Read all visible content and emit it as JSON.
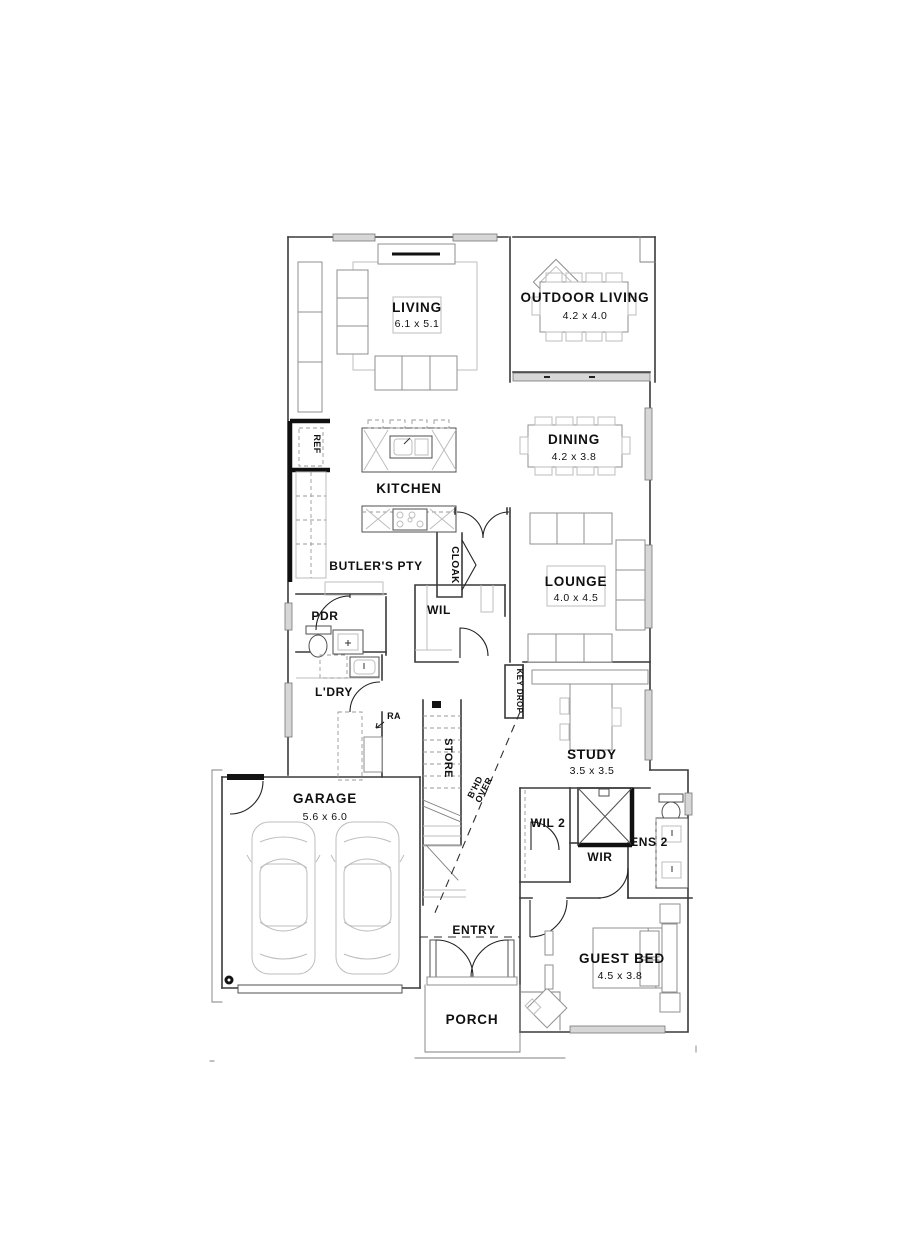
{
  "plan": {
    "rooms": {
      "living": {
        "label": "LIVING",
        "dims": "6.1 x 5.1"
      },
      "outdoor_living": {
        "label": "OUTDOOR LIVING",
        "dims": "4.2 x 4.0"
      },
      "dining": {
        "label": "DINING",
        "dims": "4.2 x 3.8"
      },
      "kitchen": {
        "label": "KITCHEN"
      },
      "ref": {
        "label": "REF"
      },
      "butlers_pantry": {
        "label": "BUTLER'S PTY"
      },
      "cloak": {
        "label": "CLOAK"
      },
      "lounge": {
        "label": "LOUNGE",
        "dims": "4.0 x 4.5"
      },
      "pdr": {
        "label": "PDR"
      },
      "wil": {
        "label": "WIL"
      },
      "laundry": {
        "label": "L'DRY"
      },
      "key_drop": {
        "label": "KEY DROP"
      },
      "store": {
        "label": "STORE"
      },
      "study": {
        "label": "STUDY",
        "dims": "3.5 x 3.5"
      },
      "garage": {
        "label": "GARAGE",
        "dims": "5.6 x 6.0"
      },
      "wil2": {
        "label": "WIL 2"
      },
      "wir": {
        "label": "WIR"
      },
      "ens2": {
        "label": "ENS 2"
      },
      "guest_bed": {
        "label": "GUEST BED",
        "dims": "4.5 x 3.8"
      },
      "entry": {
        "label": "ENTRY"
      },
      "porch": {
        "label": "PORCH"
      }
    },
    "annotations": {
      "return_air": "RA",
      "floor_over_line1": "B'HD",
      "floor_over_line2": "OVER"
    },
    "colors": {
      "wall": "#3a3a3a",
      "bold_wall": "#101010",
      "furniture": "#8f8f8f",
      "window_fill": "#d7d7d7",
      "paper": "#ffffff"
    }
  }
}
